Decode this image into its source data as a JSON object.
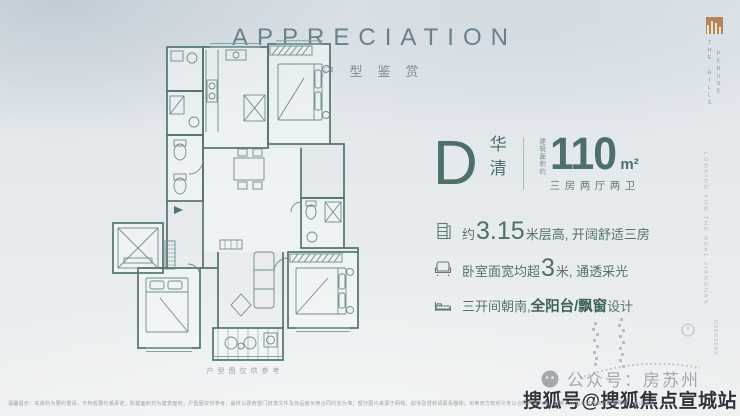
{
  "colors": {
    "accent_teal": "#4d6f6e",
    "header_grey": "#69808f",
    "bronze": "#b5835a",
    "plan_line": "#557877"
  },
  "header": {
    "title": "APPRECIATION",
    "subtitle": "户型鉴赏"
  },
  "brand": {
    "name_col_right": "PERUSE",
    "name_col_left": "THE HILLS",
    "side_text": "LOOKING FOR THE REAL JIANGNAN",
    "corner_text": "OVERSEAS"
  },
  "unit": {
    "letter": "D",
    "name": "华清",
    "area_label": "建筑面积约",
    "area_value": "110",
    "area_unit": "m²",
    "layout": "三房两厅两卫"
  },
  "features": [
    {
      "icon": "building-height-icon",
      "pre": "约",
      "big": "3.15",
      "bold": "",
      "post": "米层高, 开阔舒适三房"
    },
    {
      "icon": "sofa-icon",
      "pre": "卧室面宽均超",
      "big": "3",
      "bold": "",
      "post": "米, 通透采光"
    },
    {
      "icon": "bed-icon",
      "pre": "三开间朝南, ",
      "big": "",
      "bold": "全阳台/飘窗",
      "post": "设计"
    }
  ],
  "floorplan": {
    "caption": "户型图仅供参考"
  },
  "watermarks": {
    "wechat": "公众号：房苏州",
    "sohu": "搜狐号@搜狐焦点宣城站"
  },
  "disclaimer": {
    "text": "温馨提示：本资料为要约邀请，不构成要约或承诺；所载面积均为建筑面积，户型图仅供参考，最终以政府部门批准文件及商品房买卖合同约定为准；部分图片来源于网络，如涉及侵权请联系删除；买卖双方权利义务以合同约定为准，出卖人保留对宣传资料的解释权，敬请留意。"
  }
}
